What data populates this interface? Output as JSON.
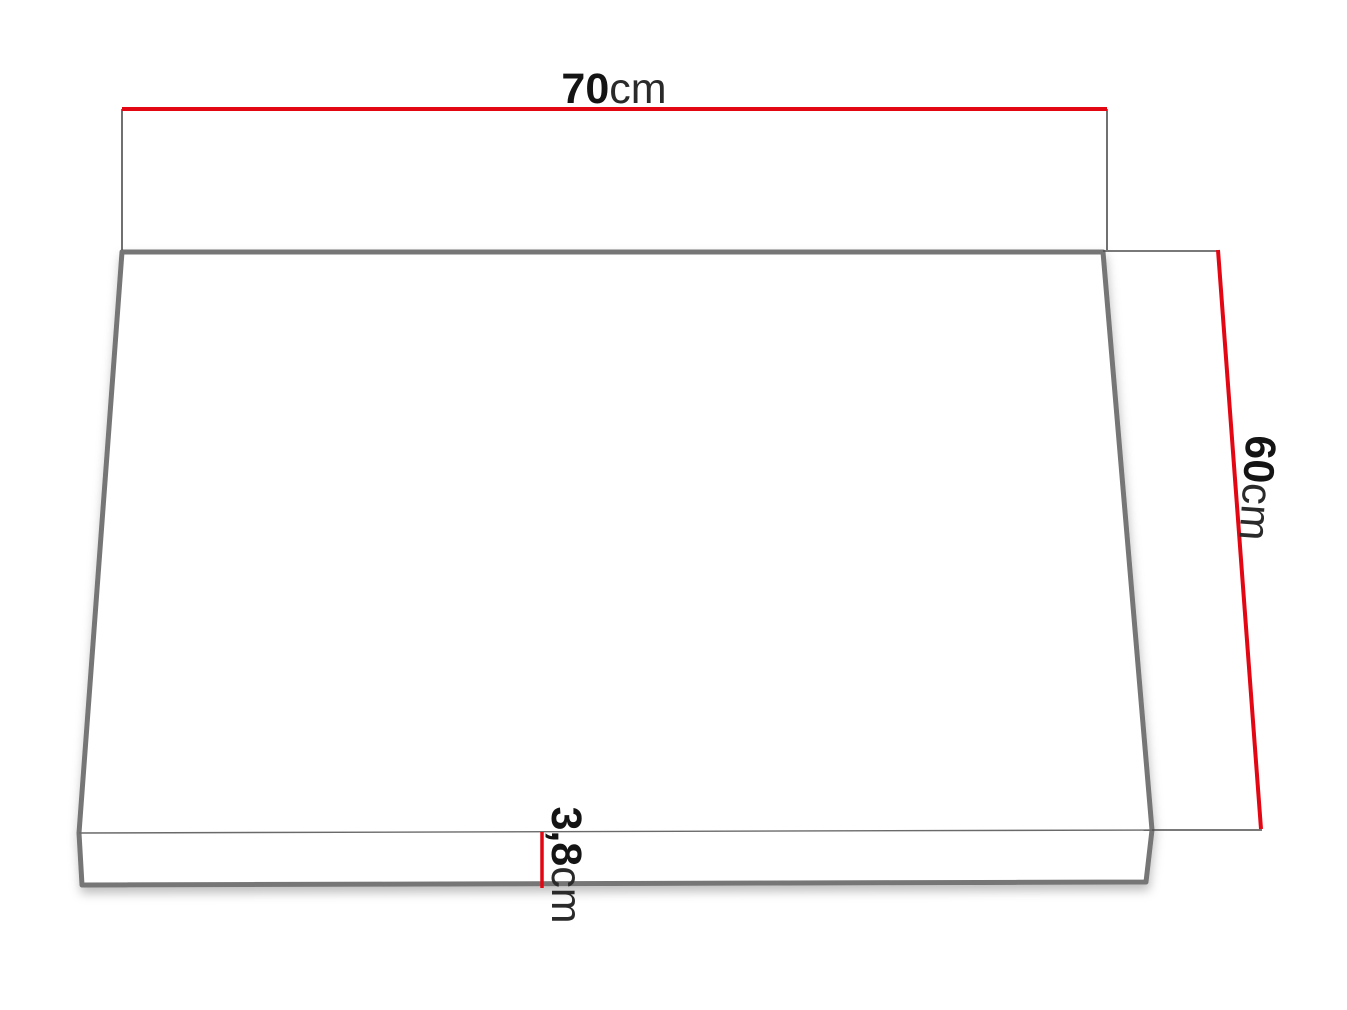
{
  "diagram": {
    "name": "panel-dimension-drawing",
    "dimensions": {
      "width": {
        "value": "70",
        "unit": "cm"
      },
      "depth": {
        "value": "60",
        "unit": "cm"
      },
      "thickness": {
        "value": "3,8",
        "unit": "cm"
      }
    },
    "colors": {
      "dimension_line": "#e30613",
      "panel_edge": "#767676",
      "extension_line": "#4d4d4d",
      "label_number": "#141414",
      "label_unit": "#2a2a2a",
      "background": "#ffffff"
    }
  }
}
